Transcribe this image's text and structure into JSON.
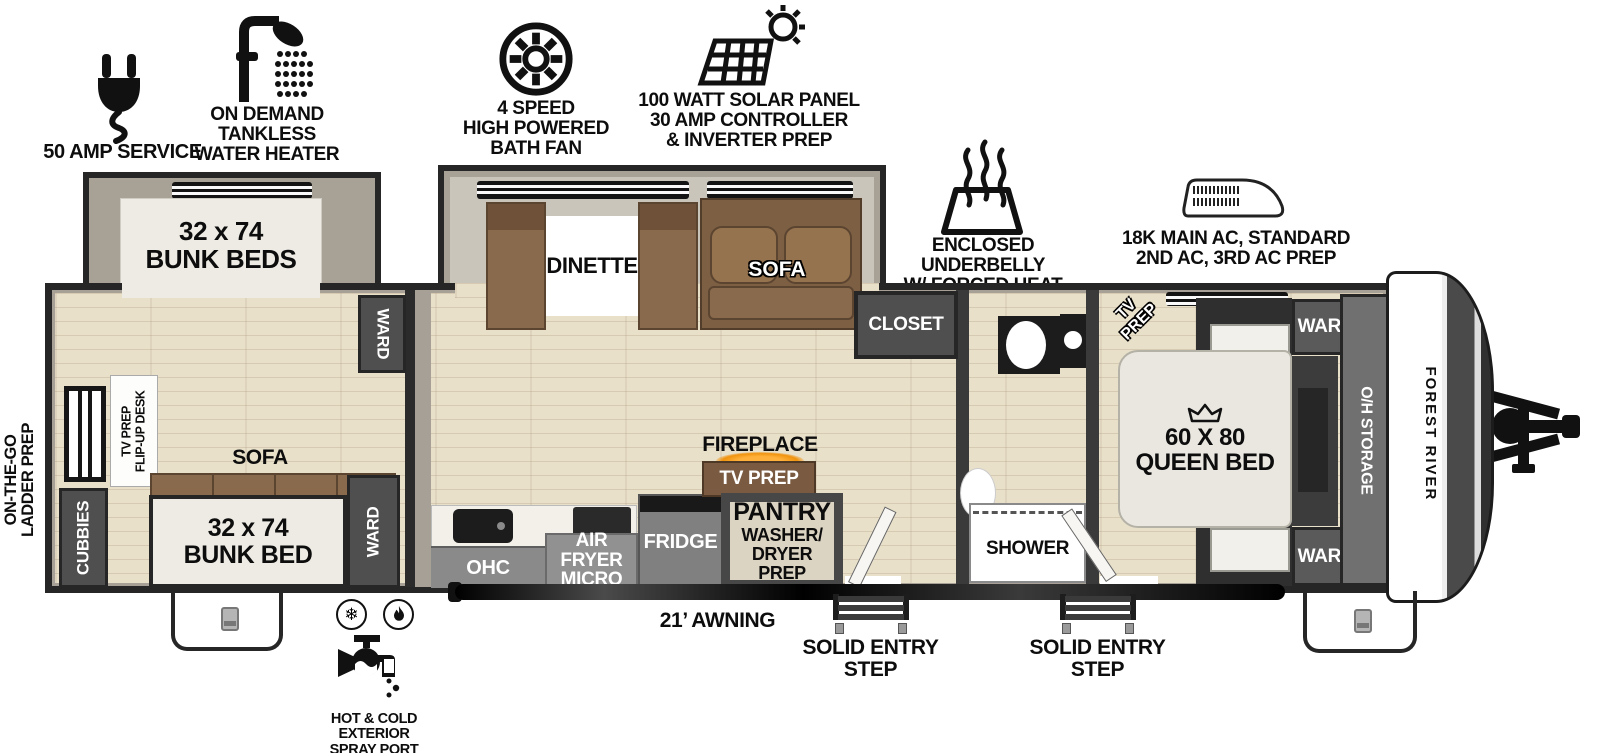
{
  "exterior": {
    "amp_service": {
      "label": "50 AMP SERVICE"
    },
    "water_heater": {
      "line1": "ON DEMAND",
      "line2": "TANKLESS",
      "line3": "WATER HEATER"
    },
    "bath_fan": {
      "line1": "4 SPEED",
      "line2": "HIGH POWERED",
      "line3": "BATH FAN"
    },
    "solar": {
      "line1": "100 WATT SOLAR PANEL",
      "line2": "30 AMP CONTROLLER",
      "line3": "& INVERTER PREP"
    },
    "underbelly": {
      "line1": "ENCLOSED UNDERBELLY",
      "line2": "W/ FORCED HEAT"
    },
    "ac": {
      "line1": "18K MAIN AC, STANDARD",
      "line2": "2ND AC, 3RD AC PREP"
    },
    "ladder": {
      "line1": "ON-THE-GO",
      "line2": "LADDER PREP"
    },
    "spray": {
      "line1": "HOT & COLD EXTERIOR",
      "line2": "SPRAY PORT"
    },
    "awning": "21’ AWNING",
    "step1": {
      "line1": "SOLID ENTRY",
      "line2": "STEP"
    },
    "step2": {
      "line1": "SOLID ENTRY",
      "line2": "STEP"
    }
  },
  "bunk_room": {
    "bunk_slide": {
      "line1": "32 x 74",
      "line2": "BUNK BEDS"
    },
    "bunk_bed": {
      "line1": "32 x 74",
      "line2": "BUNK BED"
    },
    "cubbies": "CUBBIES",
    "ward_top": "WARD",
    "ward_bottom": "WARD",
    "desk": {
      "line1": "TV PREP",
      "line2": "FLIP-UP DESK"
    },
    "sofa": "SOFA"
  },
  "main_room": {
    "dinette": "DINETTE",
    "sofa": "SOFA",
    "closet": "CLOSET",
    "ohc": "OHC",
    "air_fryer": {
      "line1": "AIR FRYER",
      "line2": "MICRO"
    },
    "fridge": "FRIDGE",
    "fireplace": "FIREPLACE",
    "tv_prep": "TV PREP",
    "pantry": {
      "line1": "PANTRY",
      "line2": "WASHER/",
      "line3": "DRYER PREP"
    }
  },
  "bathroom": {
    "shower": "SHOWER"
  },
  "bedroom": {
    "tv_prep": {
      "line1": "TV",
      "line2": "PREP"
    },
    "bed": {
      "line1": "60 X 80",
      "line2": "QUEEN BED"
    },
    "ward_top": "WARD",
    "ward_bottom": "WARD",
    "oh_storage": "O/H STORAGE"
  },
  "front": {
    "brand": "FOREST RIVER"
  },
  "colors": {
    "wall": "#262626",
    "wall_fill": "#a6a096",
    "floor": "#e9e0ca",
    "slide_fill": "#a8a296",
    "cabinet": "#4f4f4f",
    "counter_band": "#8a8a8a",
    "sofa_brown": "#8a6a4c",
    "fireplace_glow": "#f0930f",
    "bed_white": "#e9e7e0"
  }
}
